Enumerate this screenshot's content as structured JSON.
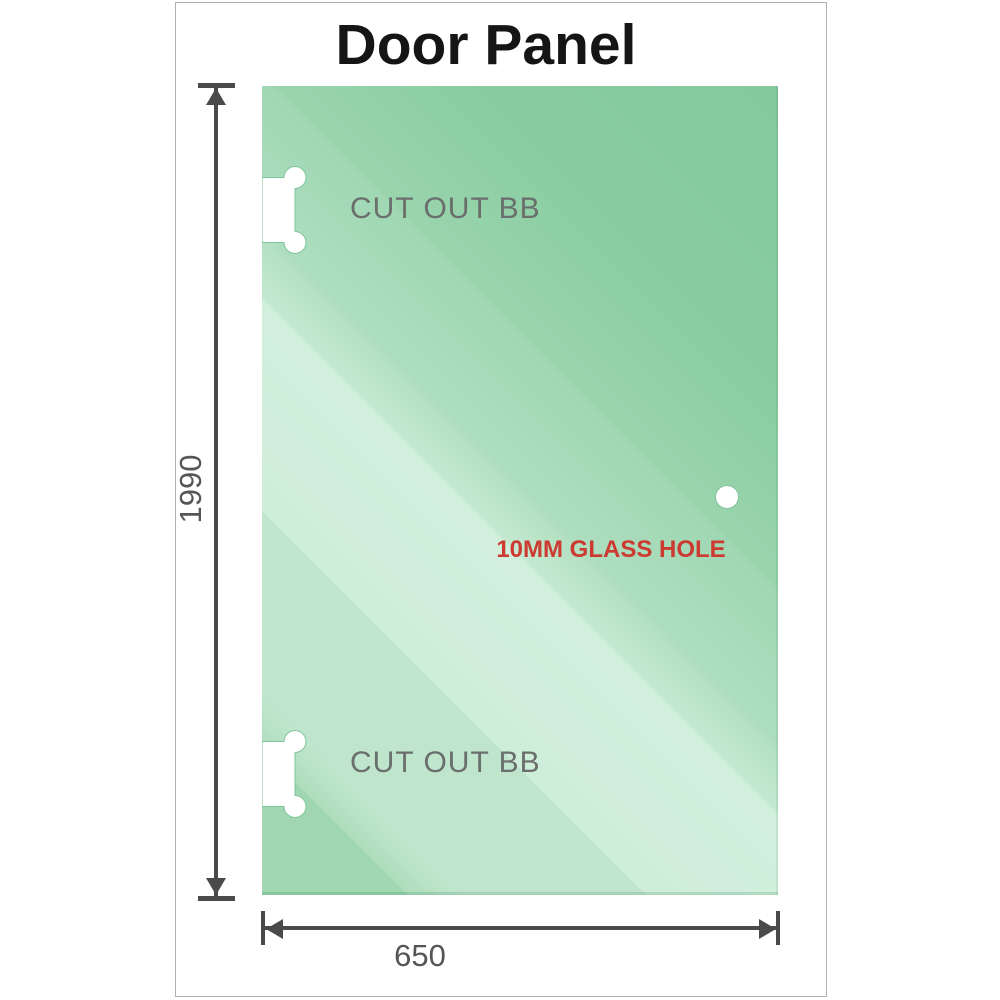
{
  "title": "Door Panel",
  "glass": {
    "cutouts": [
      {
        "label": "CUT OUT BB"
      },
      {
        "label": "CUT OUT BB"
      }
    ],
    "hole_label": "10MM GLASS HOLE"
  },
  "dimensions": {
    "height": {
      "value": "1990"
    },
    "width": {
      "value": "650"
    }
  },
  "colors": {
    "glass_deep": "#85cba0",
    "glass_mid": "#a0d7b2",
    "glass_pale": "#cfeeda",
    "dimension_line": "#4a4a4a",
    "dimension_text": "#555555",
    "cutout_text": "#6a6e6c",
    "hole_text": "#cc3a31",
    "frame_border": "#b0b0b0"
  }
}
